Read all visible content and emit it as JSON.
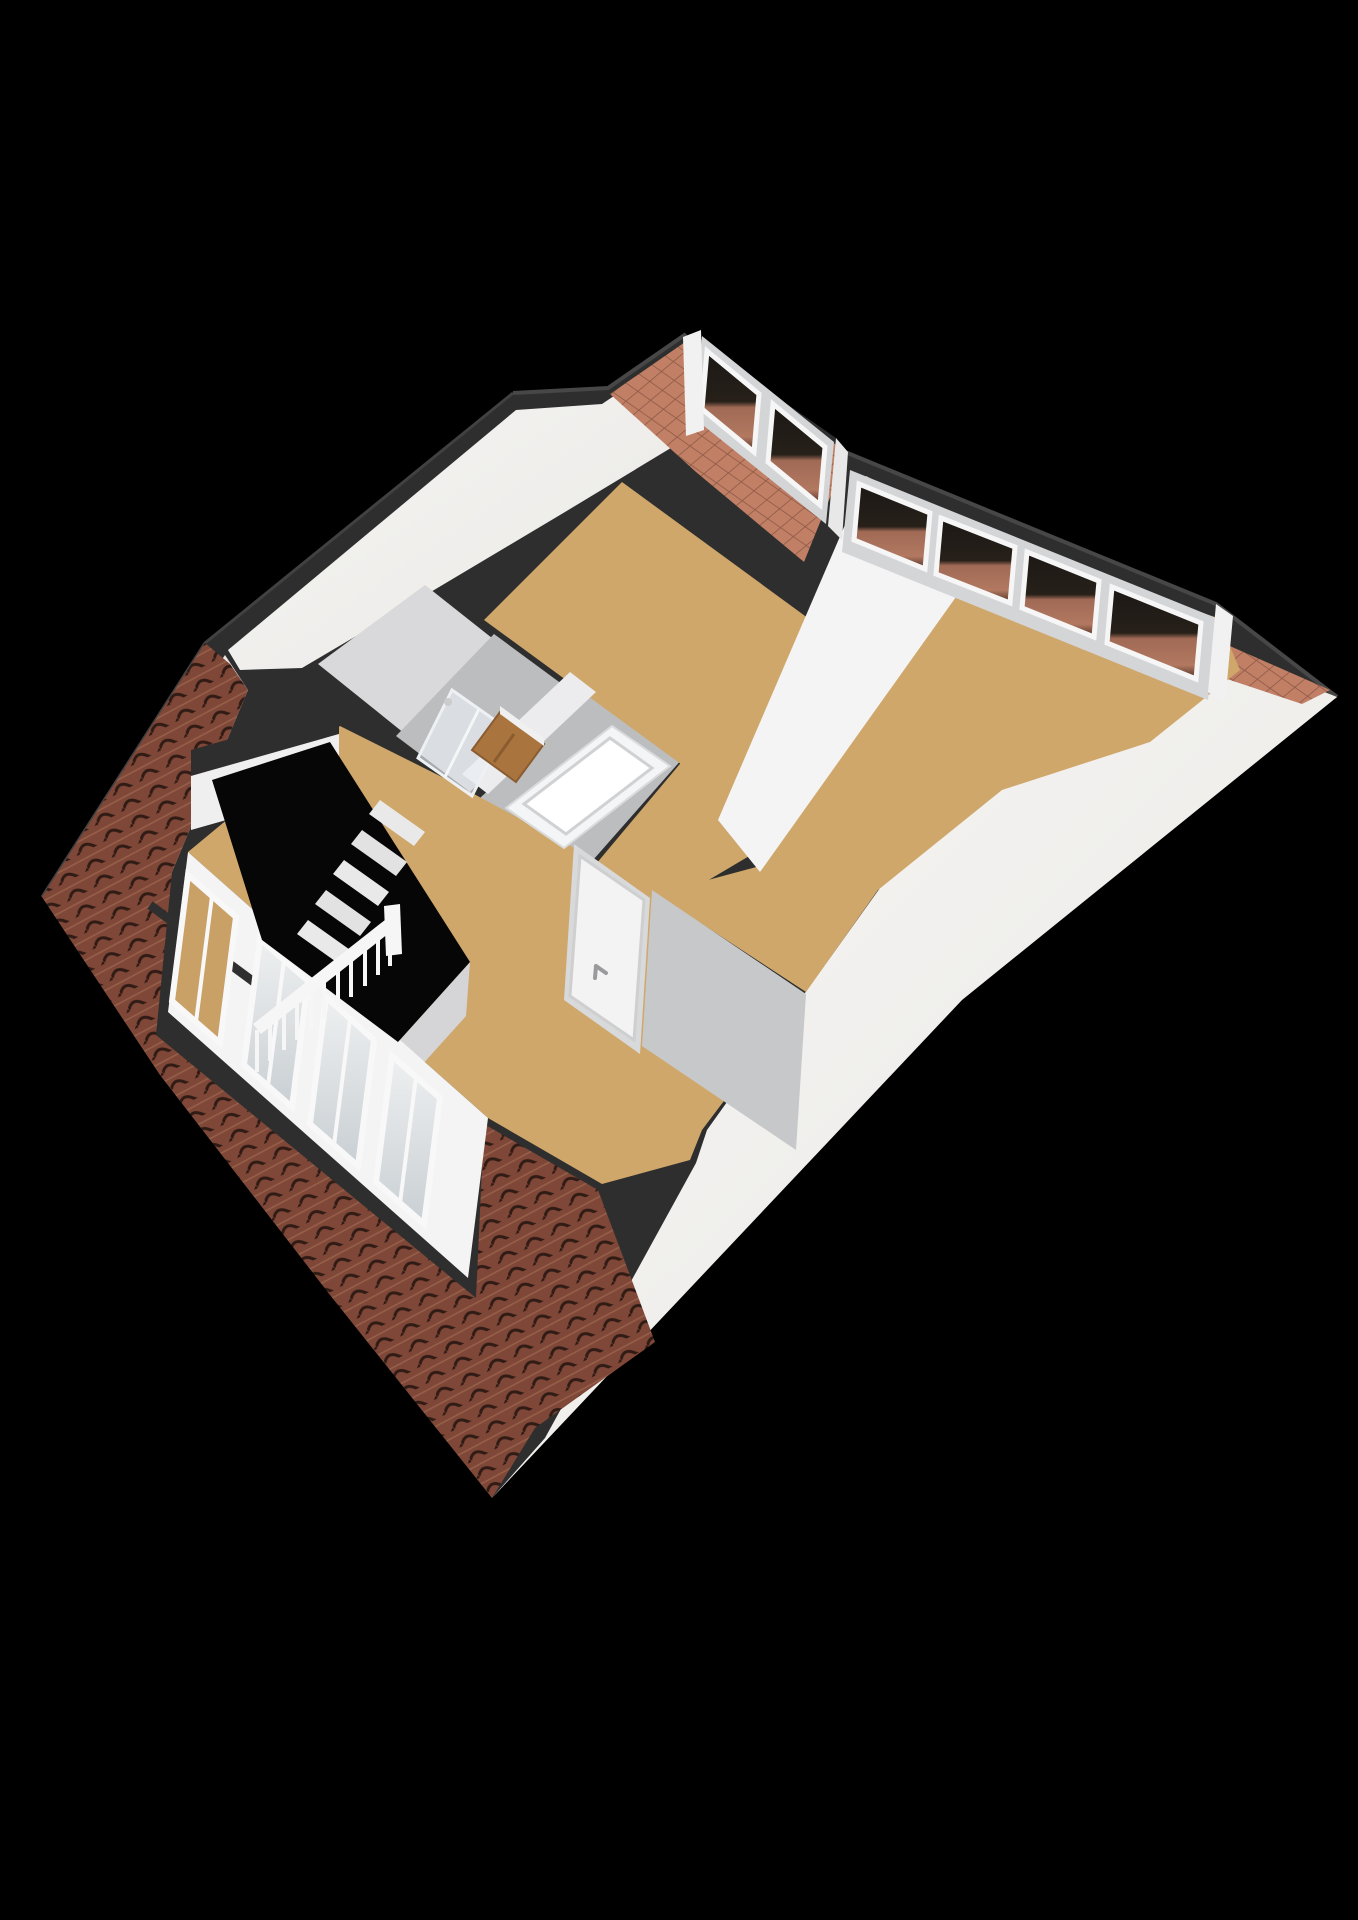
{
  "scene": {
    "kind": "3d-floorplan-render",
    "description": "Isometric 3D floor plan of an attic storey on a black background",
    "colors": {
      "background": "#000000",
      "roof_band": "#2e2e2e",
      "roof_band_highlight": "#474747",
      "roof_white": "#f2f1ee",
      "roof_white_shade": "#e7e6e3",
      "brick_tile": "#7f4737",
      "brick_groove": "#301b15",
      "brick_row": "#96604b",
      "flat_tile": "#c18065",
      "flat_tile_line": "#8f5a47",
      "floor_wood": "#cfa76b",
      "floor_bath": "#bcbdbf",
      "floor_landing": "#d9d9db",
      "wall_white": "#f4f4f4",
      "wall_face_gray": "#c7c8ca",
      "wall_face_light": "#d8d9db",
      "window_wall_gray": "#d4d5d7",
      "window_frame": "#f8f8f8",
      "glass_dark": "#211c18",
      "glass_tile_reflection": "#a86e58",
      "glass_pale": "#dfe3e5",
      "glass_floor_tint": "#c9a066",
      "door_white": "#f3f3f3",
      "door_handle": "#9a9a9c",
      "vanity_wood": "#aa743e",
      "vanity_wood_dark": "#8a5c30",
      "tub_white": "#f4f5f6",
      "tub_rim_line": "#cfd1d3",
      "shower_glass": "#e9eef2",
      "stair_void": "#060606",
      "stair_tread": "#e9e9e9",
      "railing_white": "#f6f6f6"
    },
    "inventory": {
      "rooms_visible": 6,
      "top_left_dormer_panes": 2,
      "top_right_dormer_panes": 4,
      "front_wall_windows": 4,
      "staircase_balusters": 11,
      "doors": 1,
      "bathroom_fixtures": [
        "shower",
        "vanity",
        "bathtub"
      ]
    }
  }
}
